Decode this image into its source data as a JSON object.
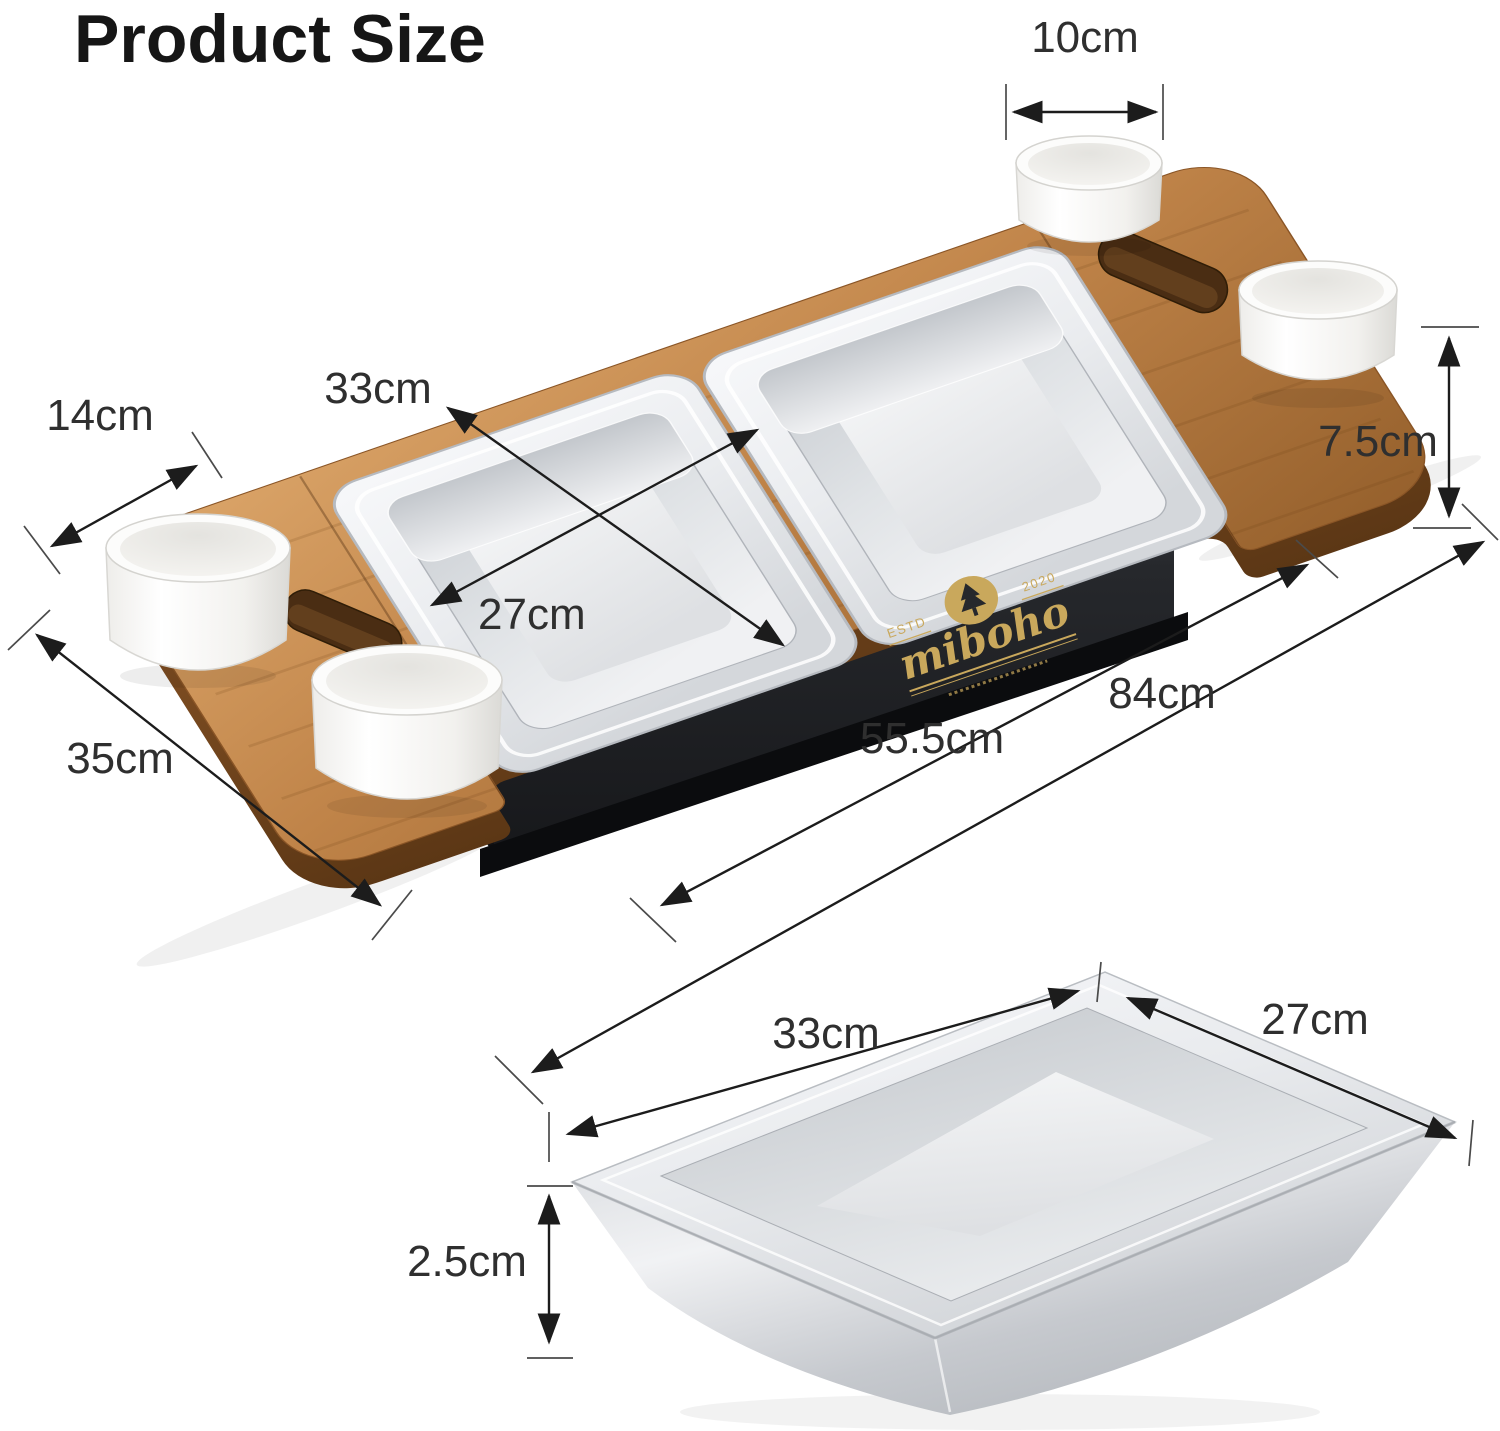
{
  "title": "Product Size",
  "colors": {
    "background": "#ffffff",
    "wood": "#c08449",
    "wood_edge": "#7c4c22",
    "steel": "#e8eaed",
    "base_black": "#232529",
    "logo_gold": "#c9a85c",
    "bowl_white": "#fcfcfb",
    "arrow": "#1c1c1c",
    "label_text": "#2f2f2f"
  },
  "assembled_view": {
    "description": "wooden serving board with two stainless steel pans, four white bowls, two handle slots and black base",
    "dims": {
      "bowl_diameter": "10cm",
      "side_wing_width": "14cm",
      "pan_length": "33cm",
      "pan_width": "27cm",
      "height": "7.5cm",
      "overall_length": "84cm",
      "base_length": "55.5cm",
      "board_depth": "35cm"
    },
    "logo": {
      "estd_label": "ESTD",
      "year_label": "2020",
      "brand_name": "miboho"
    }
  },
  "pan_detail_view": {
    "description": "single stainless steel pan",
    "dims": {
      "length": "33cm",
      "width": "27cm",
      "depth": "2.5cm"
    }
  }
}
